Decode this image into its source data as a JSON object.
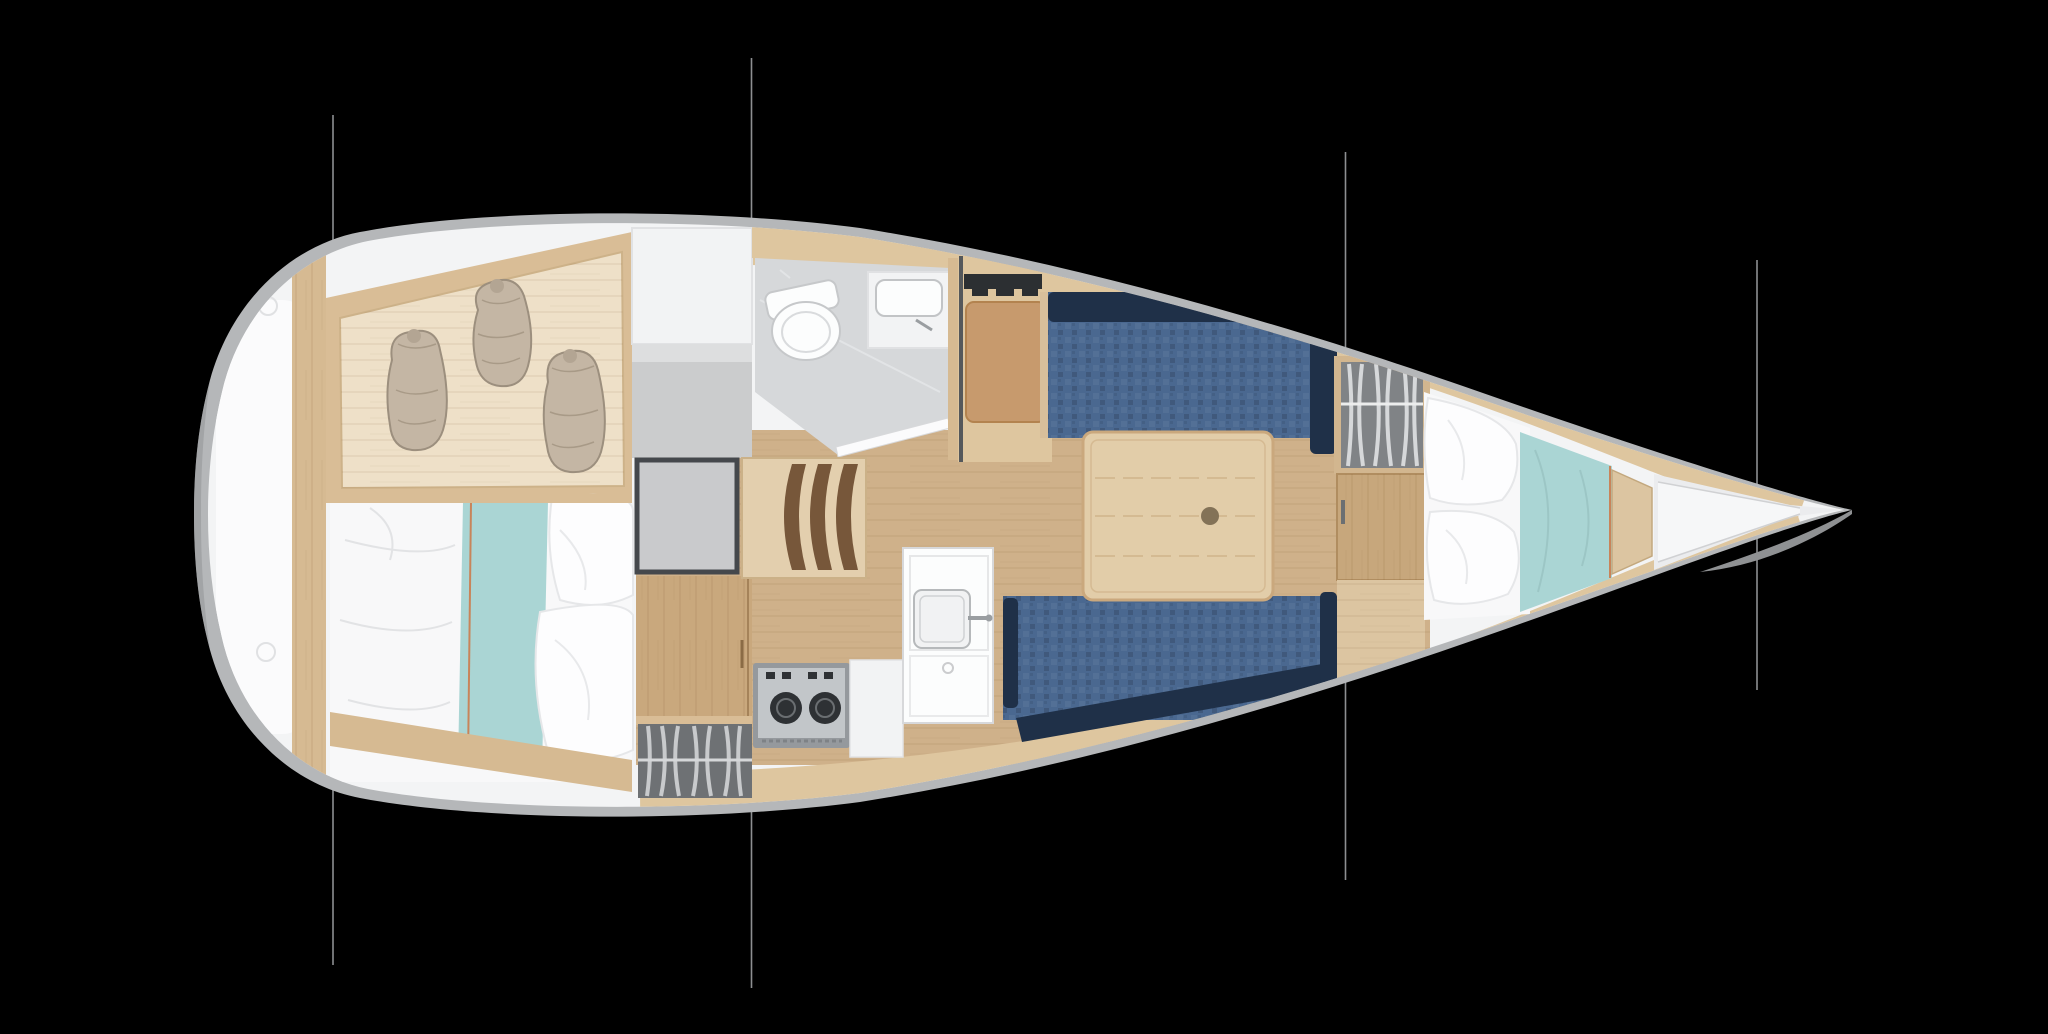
{
  "scene": {
    "type": "sailboat-interior-floor-plan",
    "description": "Top-down interior layout plan of a sailing yacht on black background, bow pointing right, stern at left",
    "background": "#000000"
  },
  "rigging": {
    "line_x_positions": [
      333,
      751.5,
      1345.5,
      1757
    ]
  },
  "regions": [
    {
      "id": "stern-deck",
      "label": "stern deck / transom"
    },
    {
      "id": "aft-cabin-shelf",
      "label": "aft cabin storage shelf with three soft bags"
    },
    {
      "id": "aft-cabin-berth",
      "label": "aft double berth with teal runner and pillows"
    },
    {
      "id": "mid-cabinets",
      "label": "cabinet column with icebox and hanging locker"
    },
    {
      "id": "head",
      "label": "head compartment with toilet and sink"
    },
    {
      "id": "companionway-steps",
      "label": "companionway steps"
    },
    {
      "id": "galley",
      "label": "galley with two-burner stove and sink unit"
    },
    {
      "id": "nav-seat",
      "label": "navigation seat with instrument panel"
    },
    {
      "id": "salon",
      "label": "salon with two navy settees and folding table"
    },
    {
      "id": "forward-wardrobe",
      "label": "hanging wardrobe"
    },
    {
      "id": "v-berth",
      "label": "forward V-berth with pillows and teal duvet"
    },
    {
      "id": "bow-deck",
      "label": "bow deck / anchor locker"
    }
  ],
  "colors": {
    "background": "#000000",
    "hull_gray": "#b5b7b9",
    "hull_shadow": "#8f9193",
    "deck_white": "#f3f4f5",
    "stern_panel": "#fbfbfc",
    "wood_band": "#dec69f",
    "wood_post": "#d6ba92",
    "shelf_frame": "#d9bd96",
    "shelf_panel": "#eee0c8",
    "bag_beige": "#c4b6a4",
    "bag_shadow": "#9c8f7e",
    "bed_white": "#f8f8f9",
    "pillow_white": "#fdfdfe",
    "teal": "#aad5d4",
    "accent_orange": "#c8845a",
    "cabinet_white": "#f2f3f4",
    "cabinet_gray": "#cbcccd",
    "box_fill": "#c9cacc",
    "box_frame": "#45484c",
    "locker_dark": "#6e7174",
    "clothes_light": "#c8cacc",
    "head_floor": "#d6d8da",
    "fixture_white": "#fcfdfd",
    "wood_floor": "#cfb18a",
    "wood_cabinet": "#c9a87d",
    "table_wood": "#e2cda9",
    "table_knob": "#837257",
    "step_brown": "#77573a",
    "step_base": "#e3cfae",
    "settee_navy": "#4a6890",
    "settee_dark": "#1f3048",
    "seat_tan": "#c79a6d",
    "instrument_dark": "#2c2f32",
    "stove_metal": "#c2c6c9",
    "stove_frame": "#95999d",
    "burner_dark": "#2e3134",
    "wardrobe_gray": "#808386",
    "door_wood": "#c7a77c",
    "vberth_step": "#dcc5a1",
    "bow_deck": "#ebecee",
    "bow_deck_bright": "#f6f7f8",
    "rigging": "#8d8f91"
  }
}
